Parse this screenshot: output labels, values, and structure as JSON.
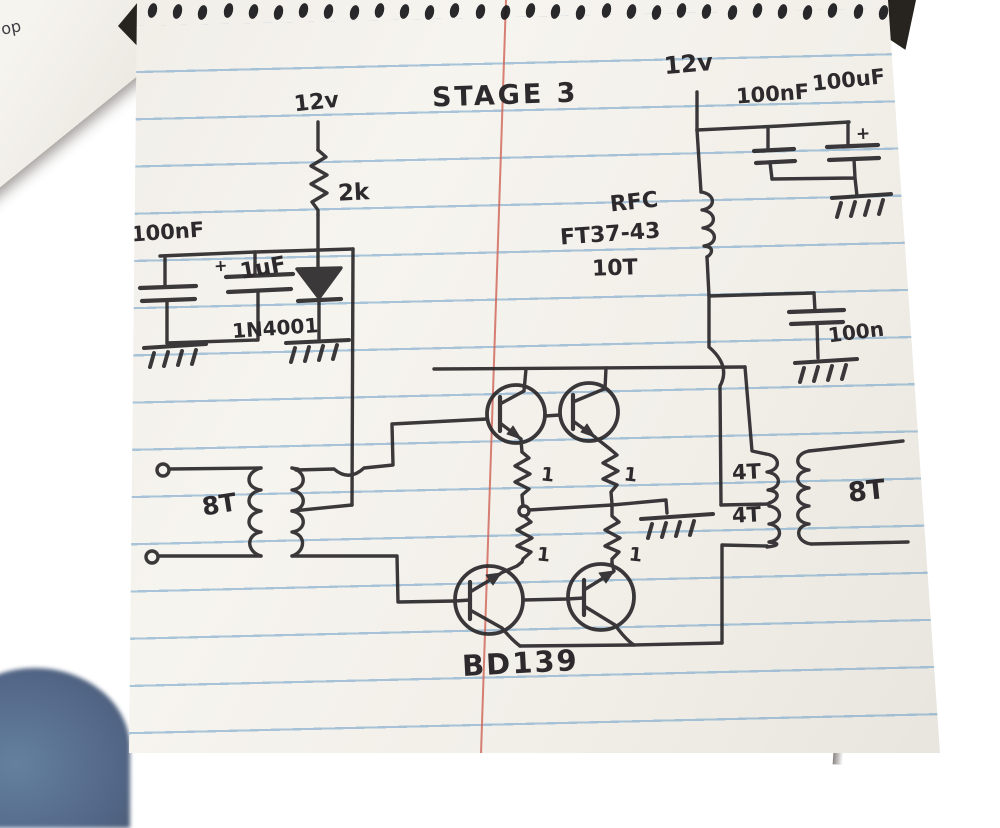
{
  "scene": {
    "desk_surface": "wood desk",
    "corner_paper_text": "op",
    "denim_object": "blue fabric corner",
    "page_type": "spiral notebook ruled page"
  },
  "schematic": {
    "title": "STAGE 3",
    "power_labels": {
      "left_supply": "12v",
      "right_supply": "12v"
    },
    "components": {
      "bias_resistor": "2k",
      "left_bypass_cap": "100nF",
      "left_electrolytic_cap": "1uF",
      "left_electrolytic_plus": "+",
      "bias_diode": "1N4001",
      "choke_name": "RFC",
      "choke_core": "FT37-43",
      "choke_turns": "10T",
      "decoupling_cap_small": "100nF",
      "decoupling_cap_large": "100uF",
      "decoupling_cap_plus": "+",
      "output_cap": "100n",
      "input_transformer_turns": "8T",
      "output_transformer_primary_top": "4T",
      "output_transformer_primary_bottom": "4T",
      "output_transformer_secondary": "8T",
      "emitter_resistor_1": "1",
      "emitter_resistor_2": "1",
      "emitter_resistor_3": "1",
      "emitter_resistor_4": "1",
      "transistor_type": "BD139"
    }
  },
  "ink_color": "#2c2a2c",
  "paper_color": "#f2efe9",
  "rule_color": "#689cc6",
  "margin_color": "#cd5e4f"
}
